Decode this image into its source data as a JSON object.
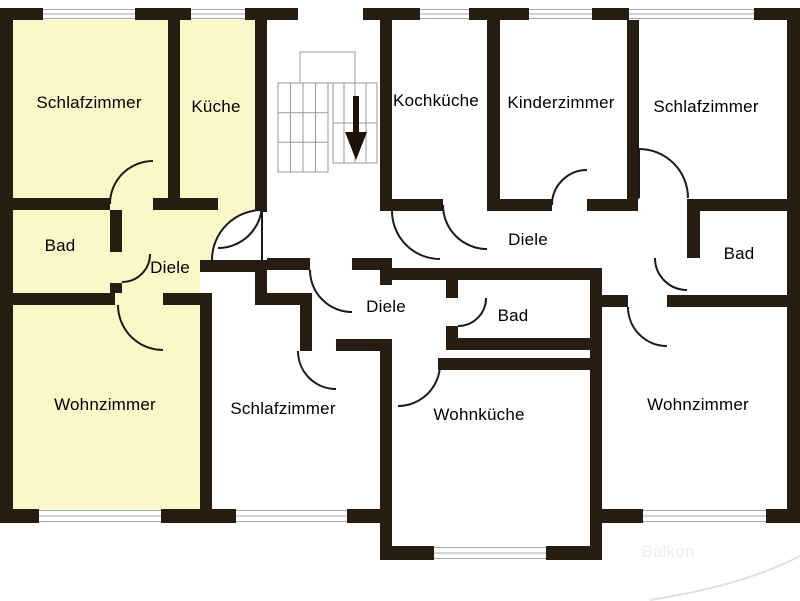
{
  "rooms": {
    "schlafzimmer_left": "Schlafzimmer",
    "kueche": "Küche",
    "bad_left": "Bad",
    "diele_left": "Diele",
    "wohnzimmer_left": "Wohnzimmer",
    "kochkueche": "Kochküche",
    "kinderzimmer": "Kinderzimmer",
    "schlafzimmer_right": "Schlafzimmer",
    "diele_right": "Diele",
    "bad_right": "Bad",
    "diele_middle": "Diele",
    "bad_middle": "Bad",
    "schlafzimmer_middle": "Schlafzimmer",
    "wohnkueche": "Wohnküche",
    "wohnzimmer_right": "Wohnzimmer",
    "balkon": "Balkon"
  },
  "icons": {
    "stairs_down_arrow": "down-arrow"
  },
  "colors": {
    "apartment_highlight": "#faf7c8",
    "wall": "#261c12",
    "window_line": "#a9a9a9",
    "stair_line": "#9a9a9a",
    "balcony_line": "#e2dfdf",
    "balkon_text": "#efecec"
  }
}
